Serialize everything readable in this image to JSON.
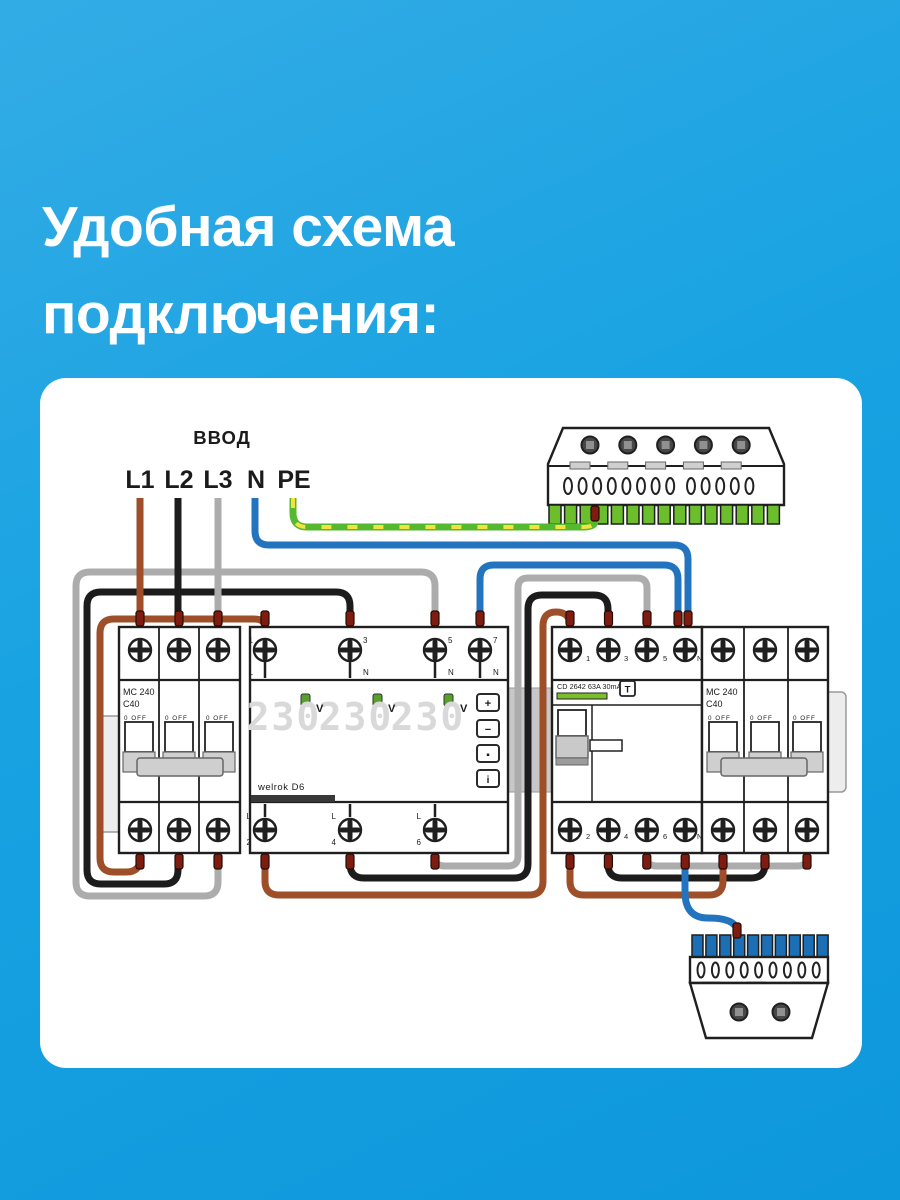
{
  "title": {
    "line1": "Удобная схема",
    "line2": "подключения:"
  },
  "colors": {
    "background": "#18A2E2",
    "card": "#FFFFFF",
    "wire_brown": "#9E4F29",
    "wire_black": "#1C1C1C",
    "wire_gray": "#ACACAC",
    "wire_blue": "#2374BE",
    "wire_green": "#55B82E",
    "wire_yellow": "#F5E33D",
    "pe_bus_green": "#6CBE2C",
    "n_bus_blue": "#1D6FB5",
    "ferrule": "#7E1C10"
  },
  "input": {
    "label": "ВВОД",
    "l1": "L1",
    "l2": "L2",
    "l3": "L3",
    "n": "N",
    "pe": "PE"
  },
  "left_breaker": {
    "model": "MC 240",
    "rating": "C40",
    "off": "0 OFF"
  },
  "right_breaker": {
    "model": "MC 240",
    "rating": "C40",
    "off": "0 OFF"
  },
  "relay": {
    "brand": "welrok D6",
    "display": {
      "v1": "230",
      "v2": "230",
      "v3": "230",
      "unit": "V"
    },
    "buttons": {
      "b1": "+",
      "b2": "−",
      "b3": "▪",
      "b4": "i"
    },
    "terminals": {
      "t1": "1",
      "t1l": "L",
      "t3": "3",
      "t3l": "N",
      "t5": "5",
      "t5l": "N",
      "t7": "7",
      "t7l": "N",
      "bl": "L",
      "b2": "2",
      "b4": "4",
      "b6": "6"
    }
  },
  "rcd": {
    "label": "CD 2642 63A 30mA",
    "test": "T",
    "t1": "1",
    "t3": "3",
    "t5": "5",
    "tn": "N",
    "b2": "2",
    "b4": "4",
    "b6": "6",
    "bn": "N"
  }
}
